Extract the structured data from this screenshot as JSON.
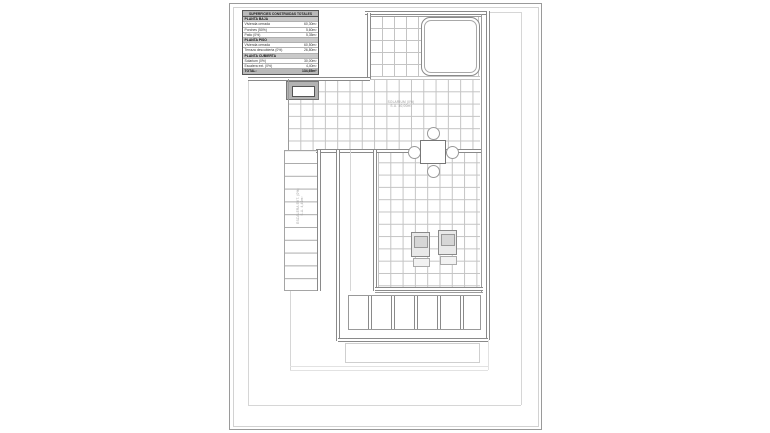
{
  "document": {
    "kind": "architectural roof-plan drawing",
    "colors": {
      "wall_line": "#8a8a8a",
      "grid_line": "#c4c4c4",
      "table_title_bg": "#b9b9b9",
      "table_section_bg": "#c9c9c9",
      "paper": "#ffffff"
    }
  },
  "area_table": {
    "title": "SUPERFICIES CONSTRUIDAS TOTALES",
    "rows": [
      {
        "label": "PLANTA BAJA",
        "value": ""
      },
      {
        "label": "Vivienda cerrada",
        "value": "60,30m²"
      },
      {
        "label": "Porches (50%)",
        "value": "5,60m²"
      },
      {
        "label": "Patio (0%)",
        "value": "5,35m²"
      },
      {
        "label": "PLANTA PISO",
        "value": ""
      },
      {
        "label": "Vivienda cerrada",
        "value": "60,50m²"
      },
      {
        "label": "Terraza descubierta (0%)",
        "value": "26,80m²"
      },
      {
        "label": "PLANTA CUBIERTA",
        "value": ""
      },
      {
        "label": "Solarium (0%)",
        "value": "30,00m²"
      },
      {
        "label": "Escalera ext. (0%)",
        "value": "4,40m²"
      },
      {
        "label": "TOTAL:",
        "value": "134,65m²"
      }
    ]
  },
  "plan_labels": {
    "solarium_line1": "SOLARIUM (0%)",
    "solarium_line2": "S.U. 30,00m²",
    "stairs_line1": "ESCALERA EXT. (0%)",
    "stairs_line2": "S.U. 4,40m²"
  }
}
